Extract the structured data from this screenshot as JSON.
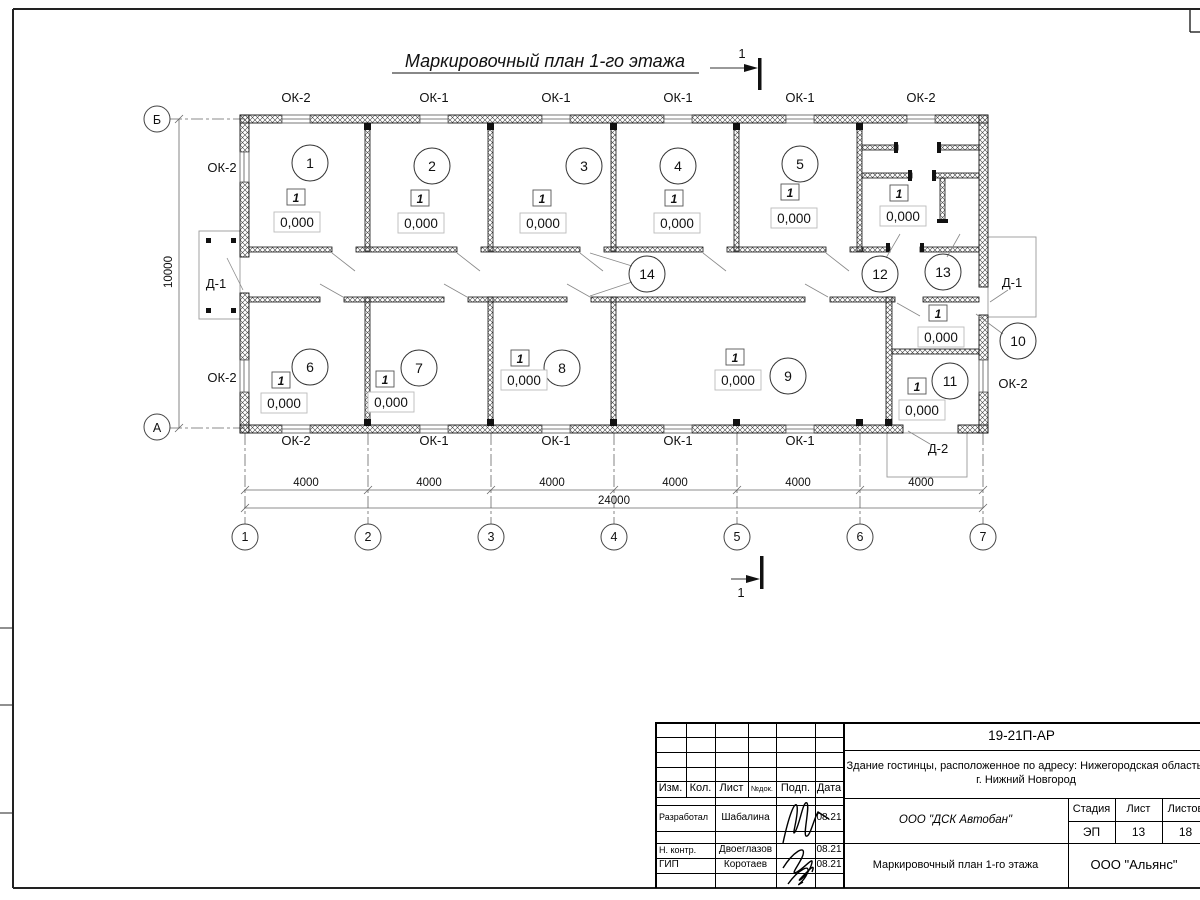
{
  "sheet": {
    "title": "Маркировочный план 1-го этажа"
  },
  "plan": {
    "rooms": [
      "1",
      "2",
      "3",
      "4",
      "5",
      "6",
      "7",
      "8",
      "9",
      "10",
      "11",
      "12",
      "13",
      "14"
    ],
    "type_mark": "1",
    "elevation": "0,000"
  },
  "labels": {
    "ok1": "ОК-1",
    "ok2": "ОК-2",
    "d1": "Д-1",
    "d2": "Д-2"
  },
  "axes": {
    "cols": [
      "1",
      "2",
      "3",
      "4",
      "5",
      "6",
      "7"
    ],
    "row_top": "Б",
    "row_bottom": "А"
  },
  "dims": {
    "bay": "4000",
    "total": "24000",
    "height": "10000"
  },
  "section": {
    "mark": "1"
  },
  "titleblock": {
    "doc_code": "19-21П-АР",
    "project": "Здание гостинцы, расположенное по адресу: Нижегородская область, г. Нижний Новгород",
    "cols": {
      "izm": "Изм.",
      "kol": "Кол.",
      "list": "Лист",
      "ndok": "№док.",
      "podp": "Подп.",
      "data": "Дата"
    },
    "rows": [
      {
        "role": "Разработал",
        "name": "Шабалина",
        "date": "08.21"
      },
      {
        "role": "Н. контр.",
        "name": "Двоеглазов",
        "date": "08.21"
      },
      {
        "role": "ГИП",
        "name": "Коротаев",
        "date": "08.21"
      }
    ],
    "contractor": "ООО \"ДСК Автобан\"",
    "sheet_title": "Маркировочный план 1-го этажа",
    "client": "ООО \"Альянс\"",
    "stage_label": "Стадия",
    "sheet_label": "Лист",
    "sheets_label": "Листов",
    "stage": "ЭП",
    "sheet_no": "13",
    "sheets_total": "18"
  }
}
